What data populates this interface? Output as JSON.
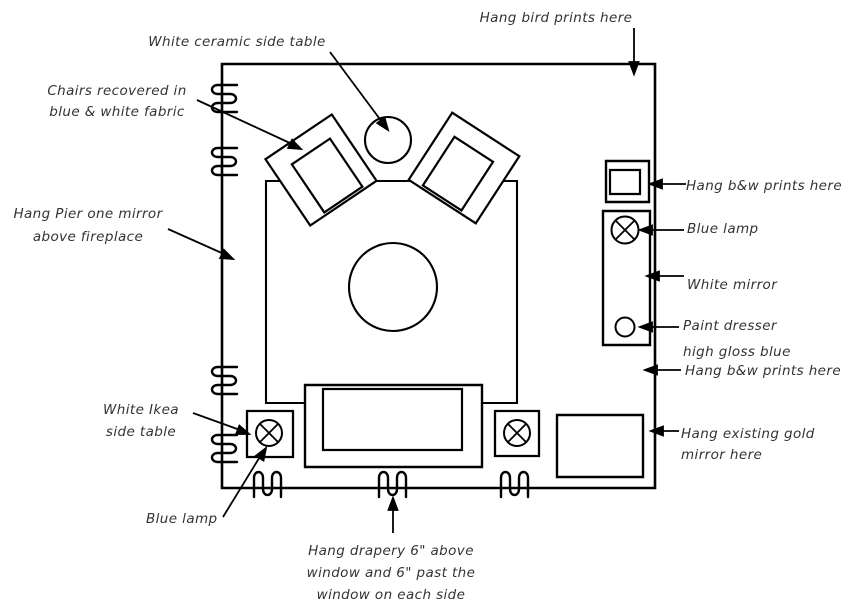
{
  "document": {
    "type": "hand-drawn interior design floor plan",
    "background_color": "#ffffff",
    "ink_color": "#000000",
    "annotation_text_color": "#333333"
  },
  "annotations": {
    "ceramic_table": {
      "lines": [
        "White ceramic side table"
      ]
    },
    "bird_prints": {
      "lines": [
        "Hang bird prints here"
      ]
    },
    "chairs": {
      "lines": [
        "Chairs recovered in",
        "blue & white fabric"
      ]
    },
    "pier_mirror": {
      "lines": [
        "Hang Pier one mirror",
        "above fireplace"
      ]
    },
    "bw_prints_top": {
      "lines": [
        "Hang b&w prints here"
      ]
    },
    "blue_lamp_right": {
      "lines": [
        "Blue lamp"
      ]
    },
    "white_mirror": {
      "lines": [
        "White mirror"
      ]
    },
    "paint_dresser": {
      "lines": [
        "Paint dresser",
        "high gloss blue"
      ]
    },
    "bw_prints_bottom": {
      "lines": [
        "Hang b&w prints here"
      ]
    },
    "ikea_table": {
      "lines": [
        "White Ikea",
        "side table"
      ]
    },
    "blue_lamp_left": {
      "lines": [
        "Blue lamp"
      ]
    },
    "drapery": {
      "lines": [
        "Hang drapery 6\" above",
        "window and 6\" past the",
        "window on each side"
      ]
    },
    "gold_mirror": {
      "lines": [
        "Hang existing gold",
        "mirror here"
      ]
    }
  },
  "symbols": [
    {
      "name": "room-outline",
      "shape": "rectangle"
    },
    {
      "name": "area-rug",
      "shape": "rectangle"
    },
    {
      "name": "armchair-left",
      "shape": "rotated nested squares"
    },
    {
      "name": "armchair-right",
      "shape": "rotated nested squares"
    },
    {
      "name": "ceramic-side-table",
      "shape": "circle"
    },
    {
      "name": "coffee-table",
      "shape": "circle"
    },
    {
      "name": "sofa",
      "shape": "nested rectangles"
    },
    {
      "name": "side-table-with-lamp",
      "shape": "square with circled X"
    },
    {
      "name": "console-table",
      "shape": "rectangle"
    },
    {
      "name": "dresser",
      "shape": "tall rectangle with lamp and knob"
    },
    {
      "name": "picture-frame",
      "shape": "nested squares"
    },
    {
      "name": "drapery-coil",
      "shape": "squiggle coil on wall"
    },
    {
      "name": "annotation-arrow",
      "shape": "line with solid arrowhead"
    }
  ]
}
